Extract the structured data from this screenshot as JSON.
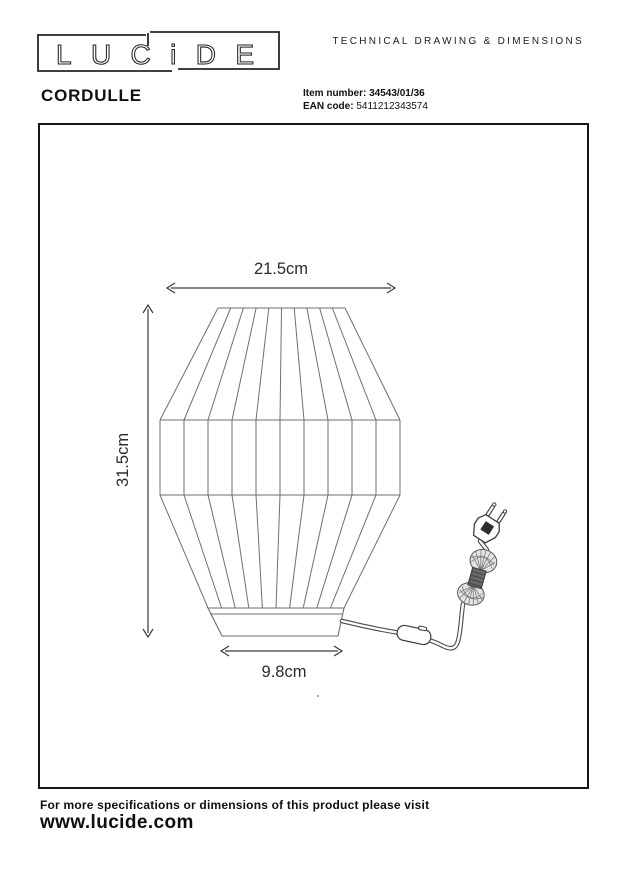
{
  "header": {
    "logo_text": "LUCiDE",
    "doc_type": "TECHNICAL DRAWING & DIMENSIONS",
    "product_name": "CORDULLE",
    "item_label": "Item number:",
    "item_value": "34543/01/36",
    "ean_label": "EAN code:",
    "ean_value": "5411212343574"
  },
  "drawing": {
    "dim_width": "21.5cm",
    "dim_height": "31.5cm",
    "dim_base": "9.8cm"
  },
  "footer": {
    "note": "For more specifications or dimensions of this product please visit",
    "website": "www.lucide.com"
  },
  "colors": {
    "frame_border": "#161616",
    "lamp_line": "#6f6f6f",
    "cord_line": "#4a4a4a",
    "dimension_line": "#3a3a3a",
    "text": "#1d1d1d"
  }
}
